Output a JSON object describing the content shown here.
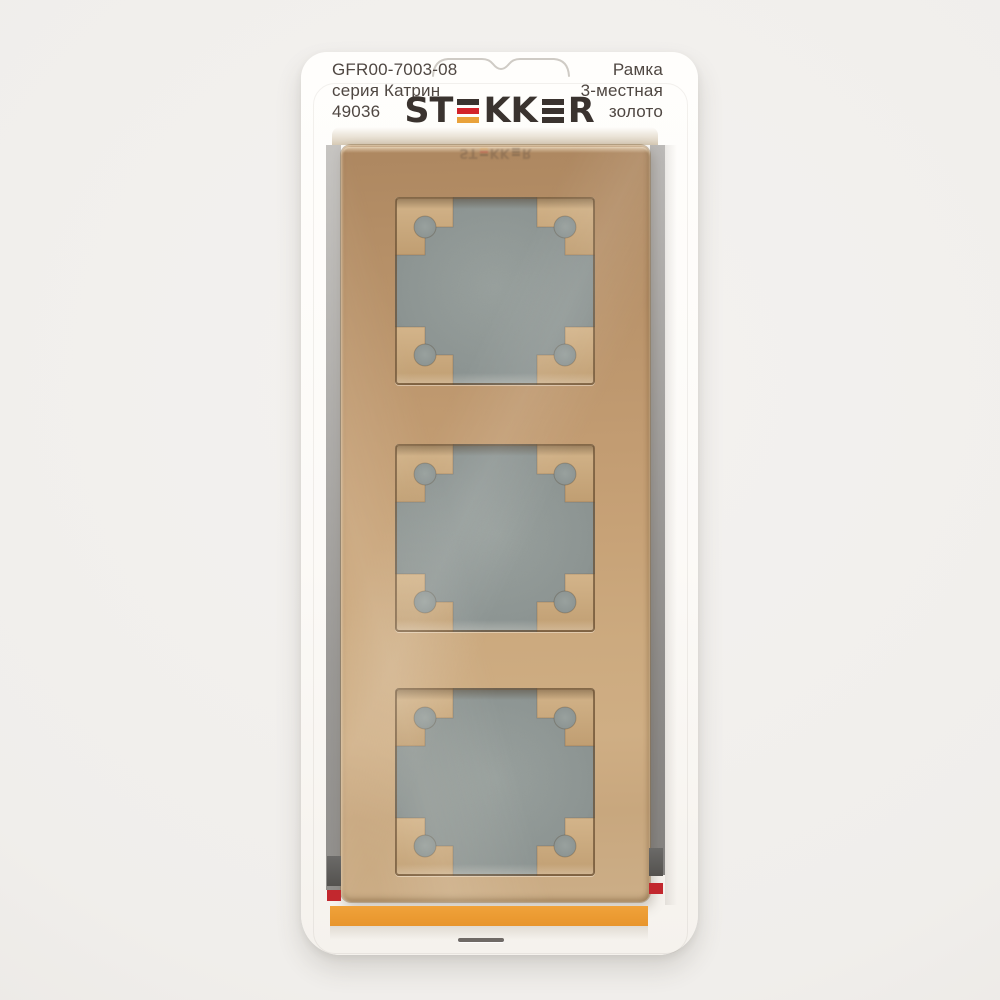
{
  "packaging": {
    "left_label": {
      "code": "GFR00-7003-08",
      "series": "серия Катрин",
      "article": "49036"
    },
    "brand": {
      "name": "STEKKER",
      "part_st": "ST",
      "part_kk": "KK",
      "part_r": "R"
    },
    "right_label": {
      "line1": "Рамка",
      "line2": "3-местная",
      "line3": "золото"
    }
  },
  "product": {
    "window_count": 3
  },
  "colors": {
    "logo_dark": "#3a332f",
    "logo_red": "#d2232a",
    "logo_gold": "#e9a23b",
    "accent_orange": "#e8952c",
    "accent_red": "#c2282e",
    "stripe_dark": "#54524f",
    "frame_gold_mid": "#c4a077",
    "backing_gray": "#8e9794",
    "text_color": "#4f4742"
  }
}
